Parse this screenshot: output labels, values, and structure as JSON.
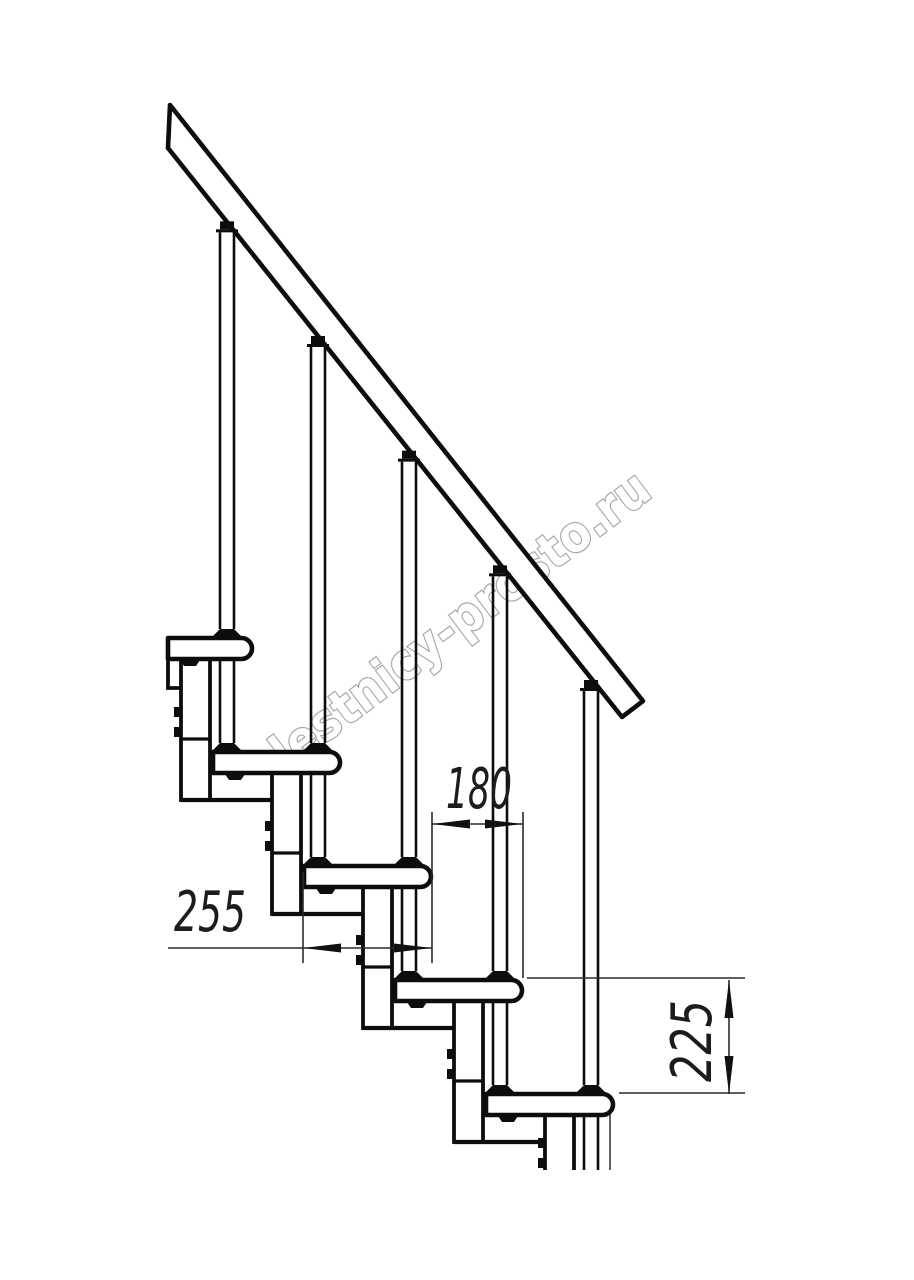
{
  "page": {
    "background": "#ffffff",
    "type": "technical-drawing",
    "subject": "modular staircase side view"
  },
  "watermark": {
    "text": "lestnicy-prosto.ru",
    "outline_color": "#a6a6a6",
    "fill_color": "#ffffff",
    "angle_deg": -37
  },
  "dimensions": {
    "line_color": "#2b2b2b",
    "arrow_color": "#111111",
    "step_run": {
      "value": "180",
      "meaning": "horizontal step offset"
    },
    "tread_depth": {
      "value": "255",
      "meaning": "tread depth"
    },
    "step_rise": {
      "value": "225",
      "meaning": "riser height"
    }
  },
  "geometry": {
    "line_color": "#0d0d0d",
    "steps": {
      "count": 5,
      "run_px": 91,
      "rise_px": 114,
      "tread_len_px": 127,
      "tread_h_px": 21,
      "first_tread": {
        "x": 213,
        "y": 752
      },
      "top_tread": {
        "x": 168,
        "y": 638,
        "w": 84
      }
    },
    "columns": {
      "width": 29,
      "drop": 141,
      "joint_offset": 101,
      "first_left": 181,
      "count": 4,
      "cut_column": {
        "x1": 545,
        "x2": 574,
        "top": 1115,
        "bottom": 1170,
        "bolts_y": [
          1138,
          1158
        ]
      }
    },
    "rods": {
      "half_w": 7,
      "first_cx": 227,
      "count": 5
    },
    "rail": {
      "poly": [
        [
          170,
          105
        ],
        [
          643,
          701
        ],
        [
          622,
          717
        ],
        [
          168,
          148
        ]
      ],
      "underside": {
        "x0": 168,
        "y0": 148,
        "slope": 1.26
      }
    },
    "stub": {
      "x": 168,
      "y1": 659,
      "y2": 688,
      "x2": 181
    },
    "extra_thin_line": {
      "x": 610,
      "y1": 1113,
      "y2": 1170
    },
    "cut_y": 1170
  }
}
